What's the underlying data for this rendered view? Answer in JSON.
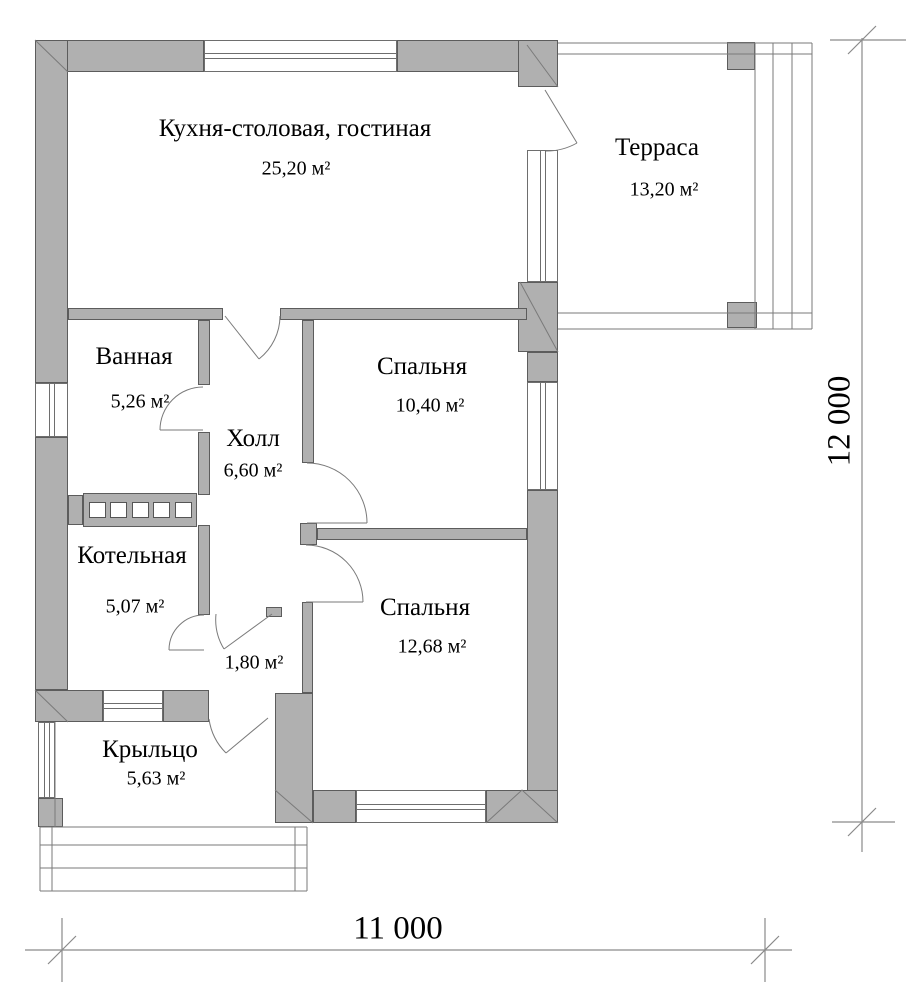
{
  "plan": {
    "title": "House floor plan",
    "rooms": {
      "kitchen": {
        "name": "Кухня-столовая, гостиная",
        "area": "25,20 м²"
      },
      "terrace": {
        "name": "Терраса",
        "area": "13,20 м²"
      },
      "bathroom": {
        "name": "Ванная",
        "area": "5,26 м²"
      },
      "hall": {
        "name": "Холл",
        "area": "6,60 м²"
      },
      "bedroom1": {
        "name": "Спальня",
        "area": "10,40 м²"
      },
      "boiler": {
        "name": "Котельная",
        "area": "5,07 м²"
      },
      "entry": {
        "area": "1,80 м²"
      },
      "bedroom2": {
        "name": "Спальня",
        "area": "12,68 м²"
      },
      "porch": {
        "name": "Крыльцо",
        "area": "5,63 м²"
      }
    },
    "dimensions": {
      "width_label": "11 000",
      "height_label": "12 000"
    },
    "colors": {
      "wall_fill": "#b0b0b0",
      "wall_edge": "#5c5c5c",
      "thin_line": "#6e6e6e",
      "text": "#000000"
    }
  }
}
